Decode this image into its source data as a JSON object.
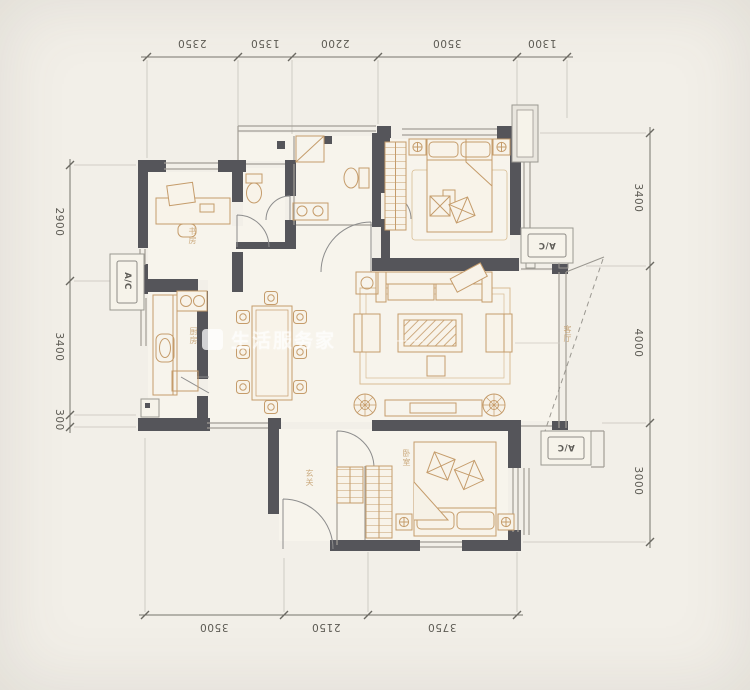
{
  "colors": {
    "background": "#f2efe8",
    "floor": "#f7f4ec",
    "wall": "#55555a",
    "furniture": "#c59c6b",
    "window": "#a29e96",
    "dimension_text": "#5c5a53"
  },
  "dimensions": {
    "top": [
      "2350",
      "1350",
      "2200",
      "3500",
      "1300"
    ],
    "bottom": [
      "3500",
      "2150",
      "3750"
    ],
    "left": [
      "2900",
      "3400",
      "300"
    ],
    "right": [
      "3400",
      "4000",
      "3000"
    ]
  },
  "ac_units": {
    "label": "A/C"
  },
  "room_labels": {
    "study": "书房",
    "kitchen": "厨房",
    "entry": "玄关",
    "bedroom": "卧室",
    "living": "客厅"
  },
  "watermark": {
    "text": "生活服务家",
    "dash": "——"
  }
}
